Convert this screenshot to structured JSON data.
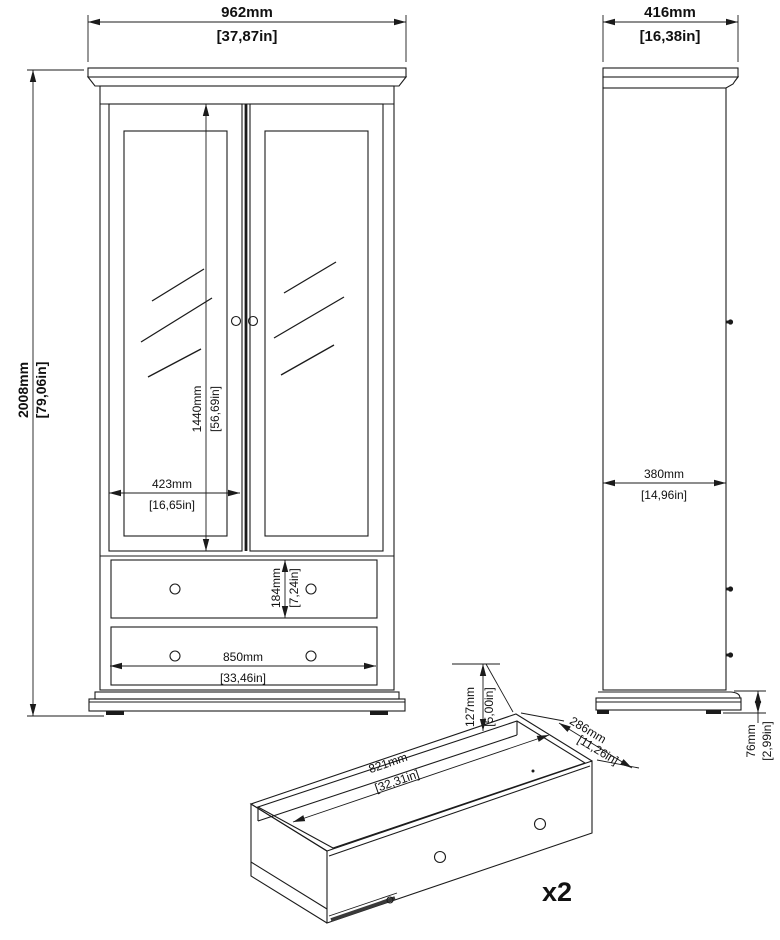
{
  "colors": {
    "line": "#1b1b1b",
    "background": "#ffffff"
  },
  "front_view": {
    "width_mm": "962mm",
    "width_in": "[37,87in]",
    "height_mm": "2008mm",
    "height_in": "[79,06in]",
    "door_height_mm": "1440mm",
    "door_height_in": "[56,69in]",
    "door_width_mm": "423mm",
    "door_width_in": "[16,65in]",
    "drawer_front_height_mm": "184mm",
    "drawer_front_height_in": "[7,24in]",
    "drawer_front_width_mm": "850mm",
    "drawer_front_width_in": "[33,46in]"
  },
  "side_view": {
    "depth_mm": "416mm",
    "depth_in": "[16,38in]",
    "body_depth_mm": "380mm",
    "body_depth_in": "[14,96in]",
    "plinth_height_mm": "76mm",
    "plinth_height_in": "[2,99in]"
  },
  "drawer_view": {
    "height_mm": "127mm",
    "height_in": "[5,00in]",
    "depth_mm": "286mm",
    "depth_in": "[11,26in]",
    "width_mm": "821mm",
    "width_in": "[32,31in]",
    "quantity_label": "x2"
  }
}
